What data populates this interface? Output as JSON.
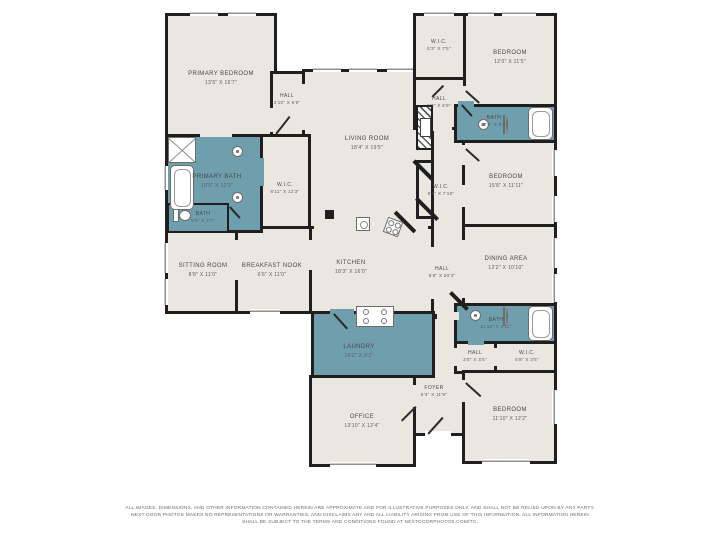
{
  "colors": {
    "wall": "#1f1f1f",
    "floor": "#e9e7df",
    "wet_room": "#6f9fad",
    "background": "#ffffff"
  },
  "rooms": [
    {
      "name": "PRIMARY BEDROOM",
      "dims": "13'5\" X 16'7\""
    },
    {
      "name": "HALL",
      "dims": "3'10\" X 6'9\""
    },
    {
      "name": "LIVING ROOM",
      "dims": "18'4\" X 19'5\""
    },
    {
      "name": "W.I.C.",
      "dims": "5'3\" X 7'5\""
    },
    {
      "name": "BEDROOM",
      "dims": "12'0\" X 11'5\""
    },
    {
      "name": "HALL",
      "dims": "5'3\" X 6'9\""
    },
    {
      "name": "BATH",
      "dims": "12'0\" X 5'0\""
    },
    {
      "name": "BEDROOM",
      "dims": "15'8\" X 11'11\""
    },
    {
      "name": "W.I.C.",
      "dims": "5'4\" X 7'10\""
    },
    {
      "name": "PRIMARY BATH",
      "dims": "10'5\" X 12'3\""
    },
    {
      "name": "W.I.C.",
      "dims": "6'11\" X 12'3\""
    },
    {
      "name": "BATH",
      "dims": "5'6\" X 2'7\""
    },
    {
      "name": "SITTING ROOM",
      "dims": "8'8\" X 11'0\""
    },
    {
      "name": "BREAKFAST NOOK",
      "dims": "6'6\" X 11'0\""
    },
    {
      "name": "KITCHEN",
      "dims": "18'3\" X 16'0\""
    },
    {
      "name": "HALL",
      "dims": "6'8\" X 20'3\""
    },
    {
      "name": "DINING AREA",
      "dims": "12'2\" X 10'10\""
    },
    {
      "name": "LAUNDRY",
      "dims": "14'2\" X 9'2\""
    },
    {
      "name": "BATH",
      "dims": "11'10\" X 4'11\""
    },
    {
      "name": "HALL",
      "dims": "3'8\" X 3'5\""
    },
    {
      "name": "W.I.C.",
      "dims": "5'8\" X 3'5\""
    },
    {
      "name": "FOYER",
      "dims": "6'4\" X 11'9\""
    },
    {
      "name": "OFFICE",
      "dims": "13'10\" X 12'4\""
    },
    {
      "name": "BEDROOM",
      "dims": "11'10\" X 12'2\""
    }
  ],
  "fixtures": [
    "shower",
    "bathtub",
    "sink",
    "toilet",
    "kitchen-island-sink",
    "cooktop",
    "range",
    "fireplace",
    "column"
  ],
  "disclaimer": {
    "line1": "ALL IMAGES, DIMENSIONS, AND OTHER INFORMATION CONTAINED HEREIN ARE APPROXIMATE AND FOR ILLUSTRATIVE PURPOSES ONLY, AND SHALL NOT BE RELIED UPON BY ANY PARTY.",
    "line2": "NEXT DOOR PHOTOS MAKES NO REPRESENTATIONS OR WARRANTIES, AND DISCLAIMS ANY AND ALL LIABILITY ARISING FROM USE OF THIS INFORMATION. ALL INFORMATION HEREIN",
    "line3": "SHALL BE SUBJECT TO THE TERMS AND CONDITIONS FOUND AT NEXTDOORPHOTOS.COM/TC."
  }
}
